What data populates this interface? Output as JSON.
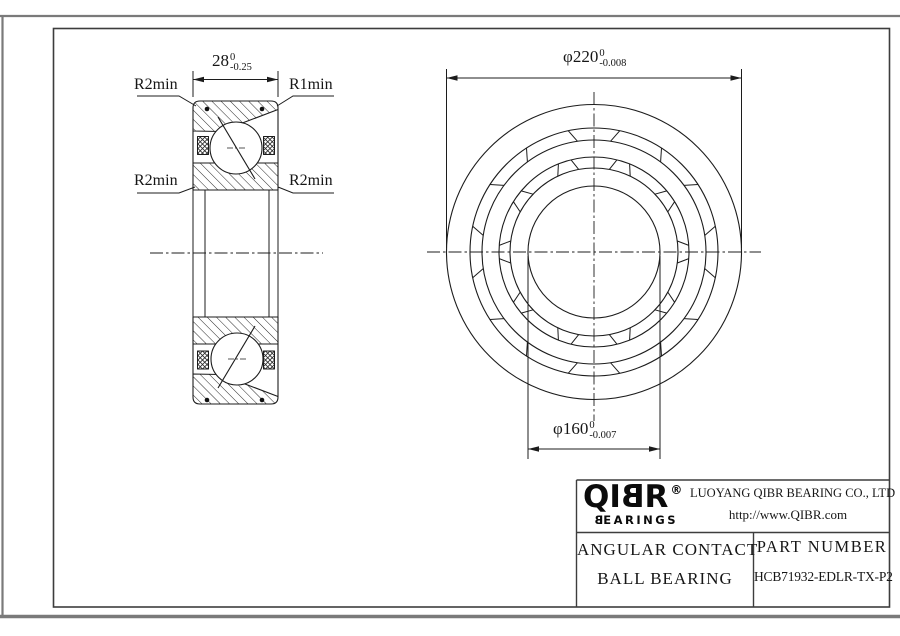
{
  "drawing": {
    "section_view": {
      "width_dim": {
        "value": "28",
        "tol_upper": "0",
        "tol_lower": "-0.25"
      },
      "corner_labels": {
        "top_left": "R2min",
        "top_right": "R1min",
        "mid_left": "R2min",
        "mid_right": "R2min"
      }
    },
    "front_view": {
      "outer_dia_dim": {
        "prefix": "φ",
        "value": "220",
        "tol_upper": "0",
        "tol_lower": "-0.008"
      },
      "bore_dia_dim": {
        "prefix": "φ",
        "value": "160",
        "tol_upper": "0",
        "tol_lower": "-0.007"
      }
    }
  },
  "title_block": {
    "logo": {
      "brand_prefix": "QI",
      "brand_mirrored_letter": "B",
      "brand_suffix": "R",
      "registered_mark": "®",
      "subtitle_mirrored_letter": "B",
      "subtitle_rest": "EARINGS"
    },
    "company_name": "LUOYANG QIBR BEARING CO., LTD",
    "website": "http://www.QIBR.com",
    "product_name_line1": "ANGULAR CONTACT",
    "product_name_line2": "BALL BEARING",
    "part_number_label": "PART NUMBER",
    "part_number": "HCB71932-EDLR-TX-P2"
  },
  "colors": {
    "line": "#1c1c1c",
    "frame_outer": "#7a7a7a",
    "frame_inner": "#3d3d3d",
    "background": "#ffffff"
  }
}
